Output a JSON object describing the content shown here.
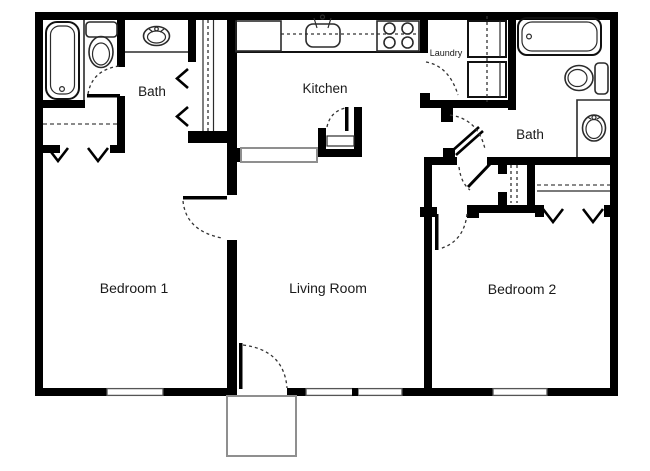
{
  "floor_plan": {
    "rooms": {
      "bedroom1": {
        "label": "Bedroom 1"
      },
      "living_room": {
        "label": "Living Room"
      },
      "bedroom2": {
        "label": "Bedroom 2"
      },
      "kitchen": {
        "label": "Kitchen"
      },
      "bath1": {
        "label": "Bath"
      },
      "bath2": {
        "label": "Bath"
      },
      "laundry": {
        "label": "Laundry"
      }
    },
    "colors": {
      "wall": "#000000",
      "background": "#ffffff",
      "text": "#1a1a1a",
      "fixture_outline": "#2b2b2b",
      "window_gray": "#8f8f8f"
    },
    "fixtures": [
      "bathtub",
      "toilet",
      "vanity-sink",
      "wardrobe-closet",
      "refrigerator",
      "kitchen-sink",
      "stove",
      "pantry",
      "breakfast-bar",
      "washer",
      "dryer",
      "bathtub",
      "toilet",
      "vanity-sink",
      "linen-closet",
      "bedroom-closet",
      "bedroom-closet",
      "entry-door",
      "porch"
    ]
  }
}
